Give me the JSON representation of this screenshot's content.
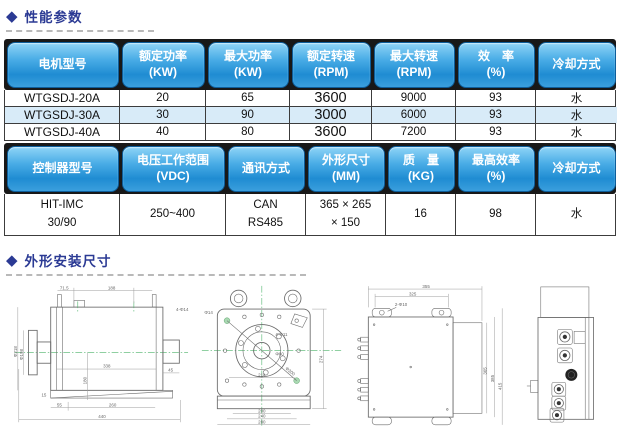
{
  "sections": {
    "performance": {
      "title": "性能参数"
    },
    "dimensions": {
      "title": "外形安装尺寸"
    }
  },
  "motor_table": {
    "headers": [
      "电机型号",
      "额定功率\n(KW)",
      "最大功率\n(KW)",
      "额定转速\n(RPM)",
      "最大转速\n(RPM)",
      "效　率\n(%)",
      "冷却方式"
    ],
    "rows": [
      [
        "WTGSDJ-20A",
        "20",
        "65",
        "3600",
        "9000",
        "93",
        "水"
      ],
      [
        "WTGSDJ-30A",
        "30",
        "90",
        "3000",
        "6000",
        "93",
        "水"
      ],
      [
        "WTGSDJ-40A",
        "40",
        "80",
        "3600",
        "7200",
        "93",
        "水"
      ]
    ]
  },
  "controller_table": {
    "headers": [
      "控制器型号",
      "电压工作范围\n(VDC)",
      "通讯方式",
      "外形尺寸\n(MM)",
      "质　量\n(KG)",
      "最高效率\n(%)",
      "冷却方式"
    ],
    "rows": [
      [
        "HIT-IMC\n30/90",
        "250~400",
        "CAN\nRS485",
        "365 × 265\n× 150",
        "16",
        "98",
        "水"
      ]
    ]
  },
  "colors": {
    "section_title": "#2b3a94",
    "header_button_top": "#8fd4f7",
    "header_button_bottom": "#1f8cd2",
    "highlight_row": "#d8ebf8",
    "center_line_green": "#4db36a"
  },
  "drawings": {
    "motor_side": {
      "dims": [
        "71.5",
        "188",
        "4-Φ14",
        "Φ218",
        "Φ198",
        "338",
        "180",
        "45",
        "15",
        "55",
        "260",
        "440"
      ]
    },
    "motor_front": {
      "dims": [
        "Φ14",
        "4-Φ11",
        "Φ80",
        "Φ300",
        "214",
        "274",
        "200",
        "240",
        "280"
      ]
    },
    "controller_side": {
      "dims": [
        "355",
        "325",
        "2-Φ10",
        "365",
        "385",
        "415"
      ]
    }
  }
}
